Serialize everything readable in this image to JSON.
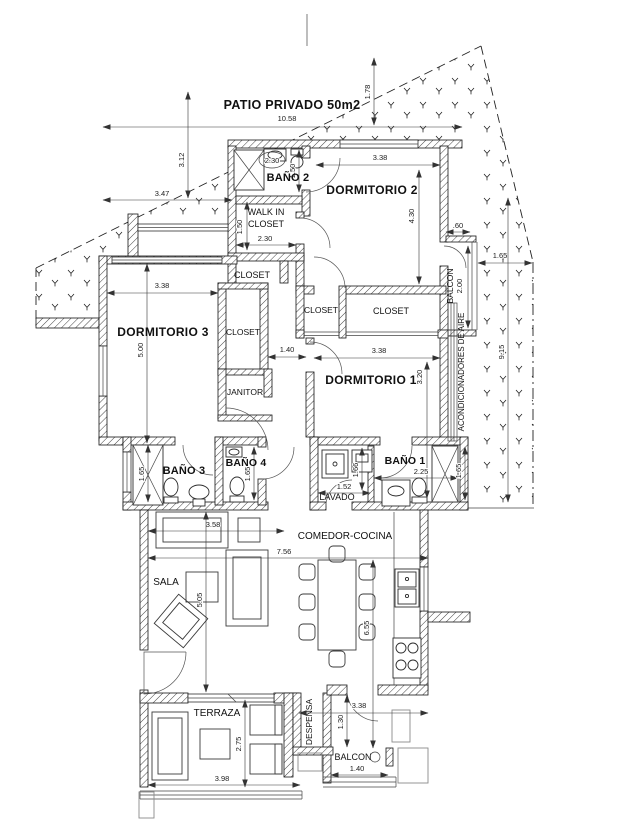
{
  "plan": {
    "colors": {
      "ink": "#141414",
      "paper": "#ffffff",
      "muted": "#8a8a8a"
    },
    "rooms": [
      {
        "id": "patio-privado",
        "label": "PATIO PRIVADO 50m2"
      },
      {
        "id": "bano-2",
        "label": "BAÑO 2"
      },
      {
        "id": "dormitorio-2",
        "label": "DORMITORIO 2"
      },
      {
        "id": "walk-in-line1",
        "label": "WALK IN"
      },
      {
        "id": "walk-in-line2",
        "label": "CLOSET"
      },
      {
        "id": "closet-a",
        "label": "CLOSET"
      },
      {
        "id": "balcon-top",
        "label": "BALCON"
      },
      {
        "id": "dormitorio-3",
        "label": "DORMITORIO 3"
      },
      {
        "id": "closet-b",
        "label": "CLOSET"
      },
      {
        "id": "closet-c",
        "label": "CLOSET"
      },
      {
        "id": "closet-d",
        "label": "CLOSET"
      },
      {
        "id": "janitor",
        "label": "JANITOR"
      },
      {
        "id": "dormitorio-1",
        "label": "DORMITORIO 1"
      },
      {
        "id": "ac",
        "label": "ACONDICIONADORES DE AIRE"
      },
      {
        "id": "bano-3",
        "label": "BAÑO 3"
      },
      {
        "id": "bano-4",
        "label": "BAÑO 4"
      },
      {
        "id": "bano-1",
        "label": "BAÑO 1"
      },
      {
        "id": "lavado",
        "label": "LAVADO"
      },
      {
        "id": "comedor-cocina",
        "label": "COMEDOR-COCINA"
      },
      {
        "id": "sala",
        "label": "SALA"
      },
      {
        "id": "terraza",
        "label": "TERRAZA"
      },
      {
        "id": "despensa",
        "label": "DESPENSA"
      },
      {
        "id": "balcon-bottom",
        "label": "BALCON"
      }
    ],
    "dims": [
      {
        "id": "patio-width",
        "text": "10.58"
      },
      {
        "id": "patio-depth-right",
        "text": "1.78"
      },
      {
        "id": "patio-depth-left",
        "text": "3.12"
      },
      {
        "id": "patio-left-width",
        "text": "3.47"
      },
      {
        "id": "bano2-width",
        "text": "2.30"
      },
      {
        "id": "bano2-height",
        "text": "1.50"
      },
      {
        "id": "dorm2-width",
        "text": "3.38"
      },
      {
        "id": "dorm2-height",
        "text": "4.30"
      },
      {
        "id": "balcon-top-width",
        "text": ".60"
      },
      {
        "id": "balcon-top-height",
        "text": "2.00"
      },
      {
        "id": "patio-right-width",
        "text": "1.65"
      },
      {
        "id": "patio-right-height",
        "text": "9.15"
      },
      {
        "id": "walkin-height",
        "text": "1.50"
      },
      {
        "id": "walkin-width",
        "text": "2.30"
      },
      {
        "id": "dorm3-width",
        "text": "3.38"
      },
      {
        "id": "dorm3-height",
        "text": "5.00"
      },
      {
        "id": "hall-width",
        "text": "1.40"
      },
      {
        "id": "dorm1-width",
        "text": "3.38"
      },
      {
        "id": "dorm1-height",
        "text": "3.20"
      },
      {
        "id": "bano3-height",
        "text": "1.65"
      },
      {
        "id": "bano4-height",
        "text": "1.65"
      },
      {
        "id": "bano1-width",
        "text": "2.25"
      },
      {
        "id": "bano1-height",
        "text": "1.65"
      },
      {
        "id": "lavado-width",
        "text": "1.52"
      },
      {
        "id": "lavado-height",
        "text": "1.66"
      },
      {
        "id": "sala-top-width",
        "text": "3.58"
      },
      {
        "id": "living-width",
        "text": "7.56"
      },
      {
        "id": "sala-height",
        "text": "5.05"
      },
      {
        "id": "comedor-height",
        "text": "6.55"
      },
      {
        "id": "kitchen-bottom",
        "text": "3.38"
      },
      {
        "id": "despensa-depth",
        "text": "1.30"
      },
      {
        "id": "terraza-height",
        "text": "2.75"
      },
      {
        "id": "terraza-width",
        "text": "3.98"
      },
      {
        "id": "balcon-bottom-width",
        "text": "1.40"
      }
    ]
  }
}
